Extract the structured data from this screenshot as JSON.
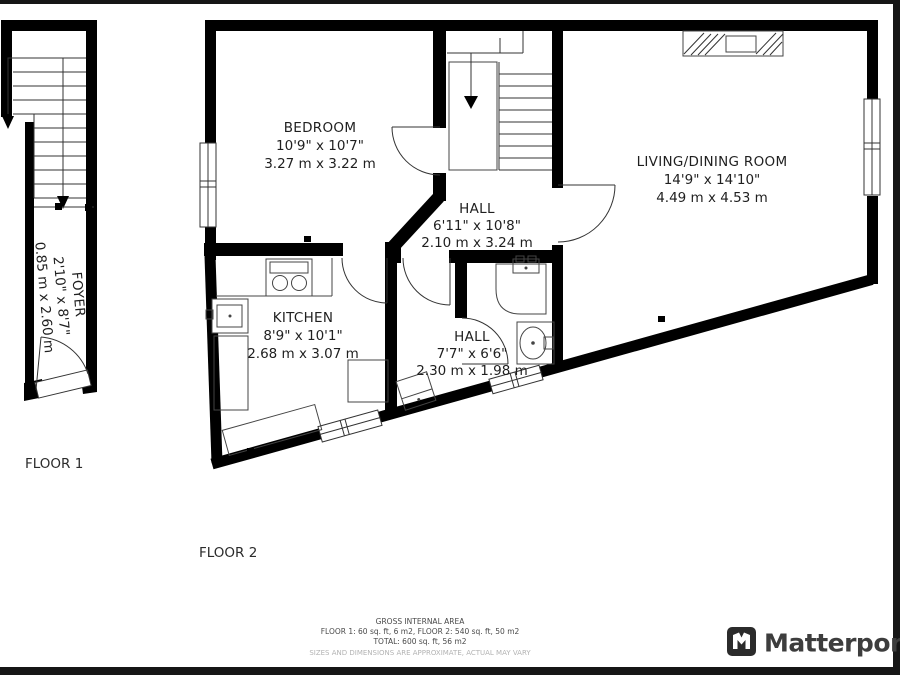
{
  "floor1": {
    "label": "FLOOR 1",
    "foyer": {
      "name": "FOYER",
      "imperial": "2'10\" x 8'7\"",
      "metric": "0.85 m x 2.60 m"
    }
  },
  "floor2": {
    "label": "FLOOR 2",
    "bedroom": {
      "name": "BEDROOM",
      "imperial": "10'9\" x 10'7\"",
      "metric": "3.27 m x 3.22 m"
    },
    "hall_upper": {
      "name": "HALL",
      "imperial": "6'11\" x 10'8\"",
      "metric": "2.10 m x 3.24 m"
    },
    "living": {
      "name": "LIVING/DINING ROOM",
      "imperial": "14'9\" x 14'10\"",
      "metric": "4.49 m x 4.53 m"
    },
    "kitchen": {
      "name": "KITCHEN",
      "imperial": "8'9\" x 10'1\"",
      "metric": "2.68 m x 3.07 m"
    },
    "hall_lower": {
      "name": "HALL",
      "imperial": "7'7\" x 6'6\"",
      "metric": "2.30 m x 1.98 m"
    }
  },
  "summary": {
    "title": "GROSS INTERNAL AREA",
    "floors_line": "FLOOR 1: 60 sq. ft, 6 m2, FLOOR 2: 540 sq. ft, 50 m2",
    "total_line": "TOTAL: 600 sq. ft, 56 m2",
    "disclaimer": "SIZES AND DIMENSIONS ARE APPROXIMATE, ACTUAL MAY VARY"
  },
  "brand": {
    "name": "Matterport"
  },
  "colors": {
    "wall": "#000000",
    "label_text": "#1f1f1f",
    "summary_text": "#4a4a4a",
    "disclaimer_text": "#b3b3b3",
    "logo_icon": "#2b2b2b",
    "logo_text": "#3d3d3d",
    "frame_bar": "#161616"
  }
}
